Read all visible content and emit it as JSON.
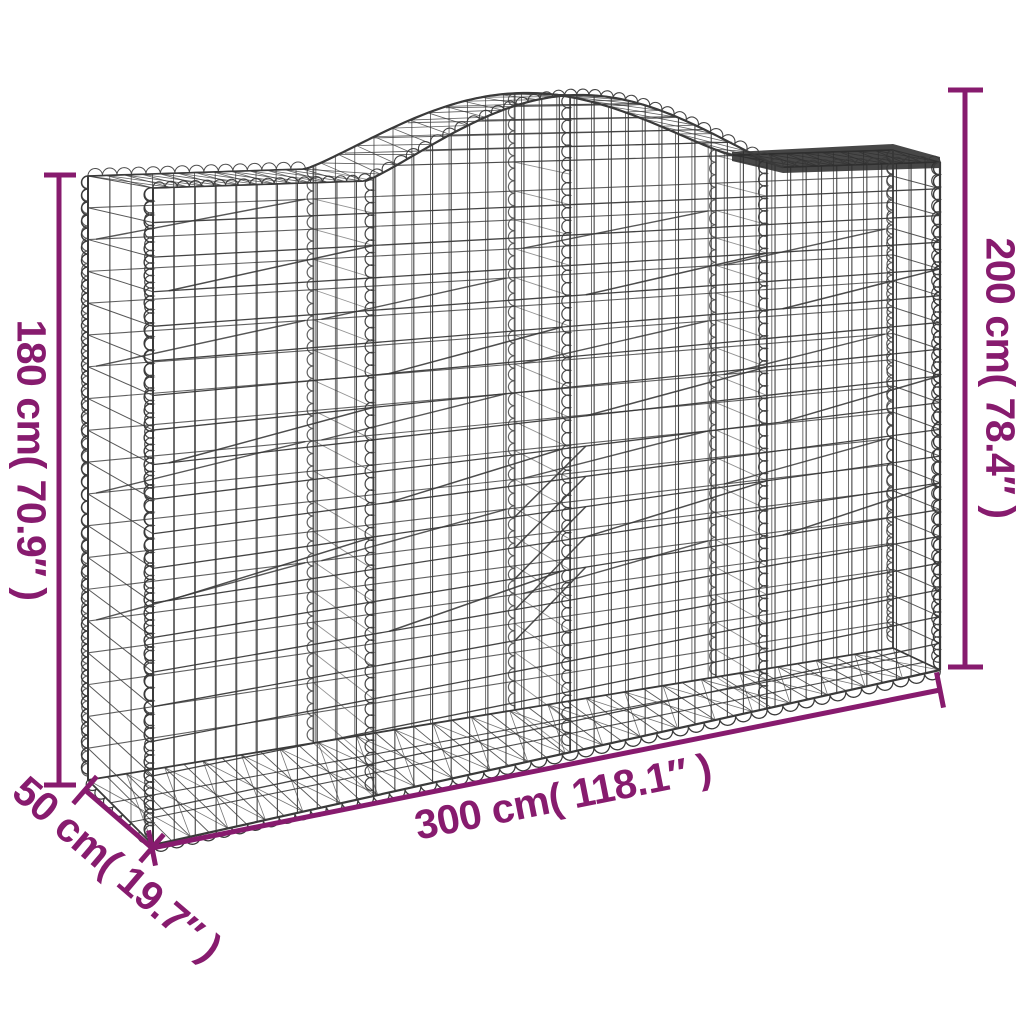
{
  "diagram": {
    "labels": {
      "height_left": "180 cm( 70.9″ )",
      "height_right": "200 cm( 78.4″ )",
      "length_bottom": "300 cm( 118.1″ )",
      "depth_bottom_left": "50 cm( 19.7″ )"
    },
    "colors": {
      "dimension": "#871b6e",
      "wire": "#3a3a3a",
      "wire_dark": "#2e2e2e",
      "background": "#ffffff"
    }
  }
}
